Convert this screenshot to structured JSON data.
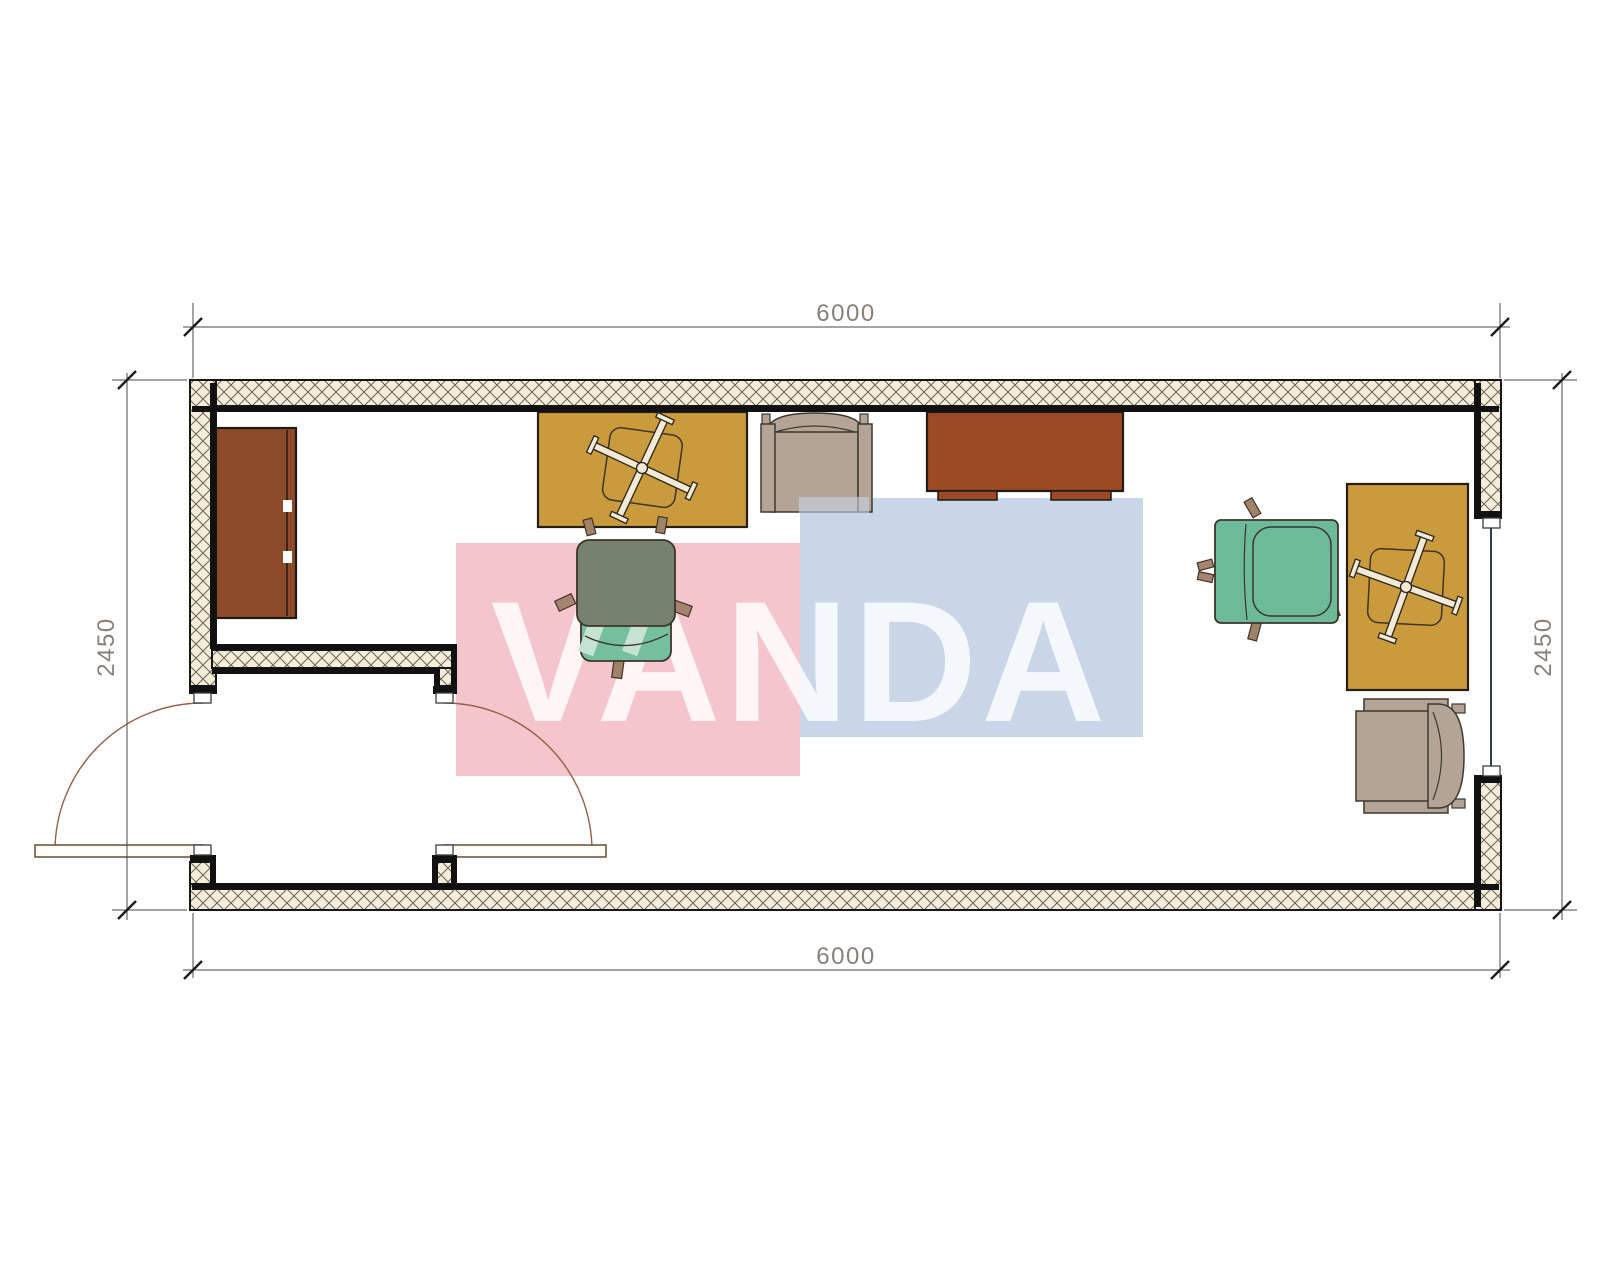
{
  "drawing": {
    "title": "container-office-floor-plan",
    "dimensions": {
      "top_width_mm": "6000",
      "bottom_width_mm": "6000",
      "left_depth_mm": "2450",
      "right_depth_mm": "2450"
    },
    "watermark": {
      "text": "VANDA",
      "pink_color": "#f5c5cc",
      "blue_color": "#c9d6e8"
    },
    "colors": {
      "wall_hatch_bg": "#f4edda",
      "wall_hatch_line": "#6f6354",
      "wall_line": "#111111",
      "desk_yellow": "#c99b3d",
      "desk_brown": "#9c4a24",
      "cabinet_brown": "#8c4a2b",
      "chair_teal": "#6cba98",
      "chair_seat_teal": "#74bf9e",
      "chair_back_olive": "#76826d",
      "chair_beige": "#b3a495",
      "caster_tan": "#a08267",
      "cross_cream": "#f3ead6",
      "door_arc": "#96604a",
      "door_leaf": "#fffef9",
      "window_glass": "#2c3a5e",
      "dimension_text": "#87817a"
    },
    "symbols": [
      "sideboard-cabinet",
      "desk-with-chair-cross",
      "armchair",
      "credenza-desk",
      "office-chair",
      "office-chair",
      "desk-with-chair-cross",
      "armchair",
      "double-swing-door",
      "window"
    ]
  }
}
